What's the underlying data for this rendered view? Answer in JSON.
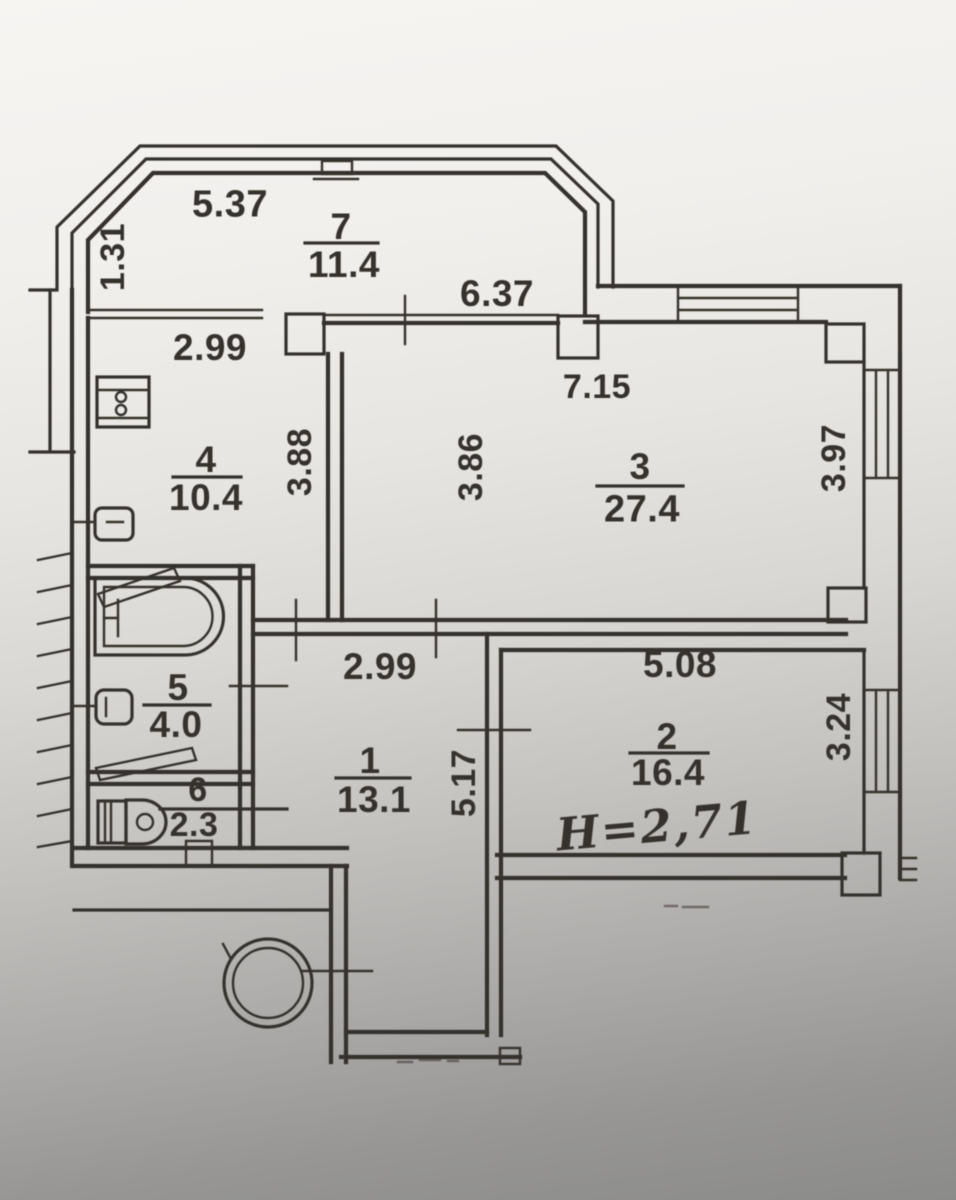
{
  "rooms": {
    "r1": {
      "number": "1",
      "area": "13.1"
    },
    "r2": {
      "number": "2",
      "area": "16.4"
    },
    "r3": {
      "number": "3",
      "area": "27.4"
    },
    "r4": {
      "number": "4",
      "area": "10.4"
    },
    "r5": {
      "number": "5",
      "area": "4.0"
    },
    "r6": {
      "number": "6",
      "area": "2.3"
    },
    "r7": {
      "number": "7",
      "area": "11.4"
    }
  },
  "dimensions": {
    "balcony_width": "5.37",
    "balcony_depth": "1.31",
    "kitchen_balcony_window": "2.99",
    "balcony_wall": "6.37",
    "room3_width": "7.15",
    "kitchen_depth": "3.88",
    "room3_depth": "3.86",
    "room3_window": "3.97",
    "hallway_width": "2.99",
    "room2_width": "5.08",
    "room2_window": "3.24",
    "hallway_depth": "5.17"
  },
  "annotations": {
    "ceiling_height": "H=2,71"
  },
  "colors": {
    "ink": "#36322d",
    "paper": "#f5f4f1"
  }
}
